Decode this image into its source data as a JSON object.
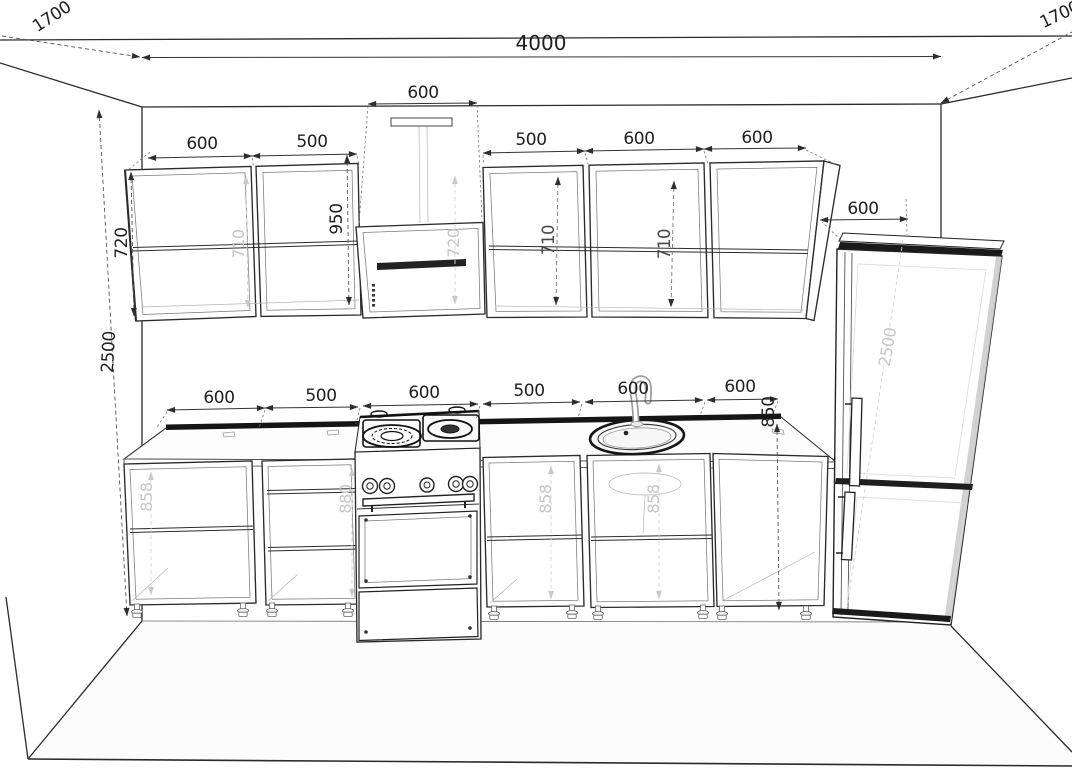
{
  "drawing_colors": {
    "line": "#2b2b2b",
    "dark_fill": "#141414",
    "dim_text": "#1f1f1f",
    "faint_text": "#c7c7c7"
  },
  "dims": {
    "total_width": "4000",
    "left_wall_depth": "1700",
    "right_wall_depth": "1700",
    "wall_height": "2500",
    "hood_width": "600",
    "wall_cab_1_width": "600",
    "wall_cab_2_width": "500",
    "wall_cab_3_width": "500",
    "wall_cab_4_width": "600",
    "wall_cab_5_width": "600",
    "fridge_width": "600",
    "wall_cab_height": "720",
    "hood_body_height": "720",
    "wall_cab_2_interior_height": "710",
    "wall_cab_3_interior_height": "710",
    "wall_cab_4_interior_height": "710",
    "hood_clearance": "950",
    "base_cab_1_width": "600",
    "base_cab_2_width": "500",
    "stove_width": "600",
    "base_cab_4_width": "500",
    "sink_cab_width": "600",
    "base_cab_6_width": "600",
    "counter_height": "850",
    "base_cab_1_interior_height": "858",
    "base_cab_2_interior_height": "880",
    "base_cab_4_interior_height": "858",
    "sink_cab_interior_height": "858",
    "fridge_height": "2500"
  }
}
